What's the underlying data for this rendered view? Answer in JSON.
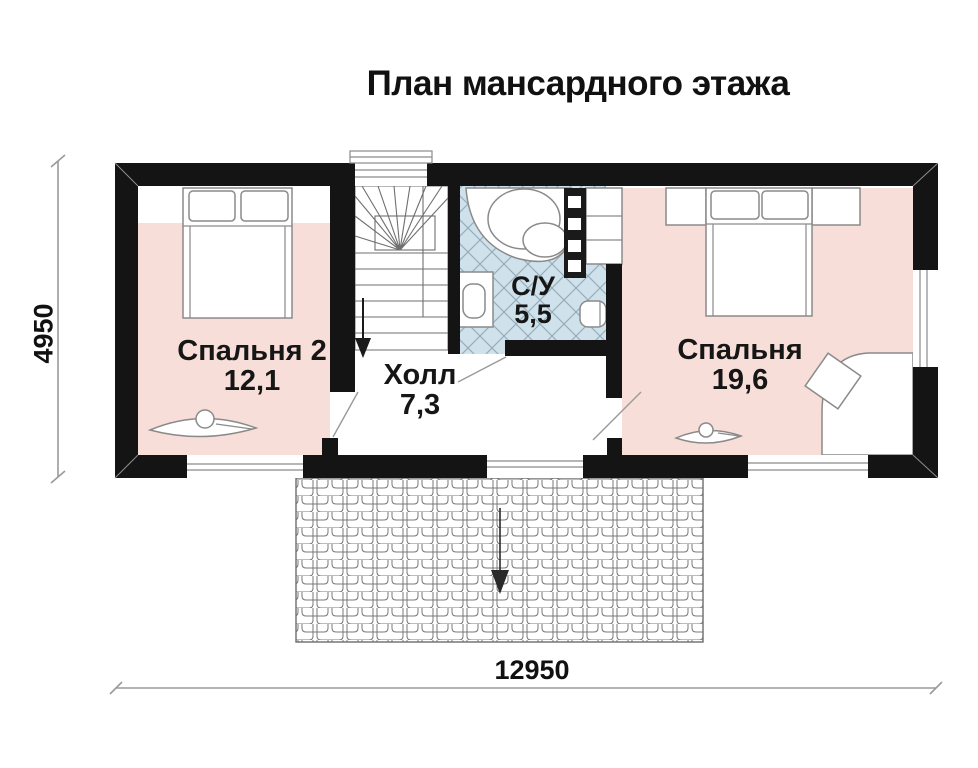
{
  "title": "План мансардного этажа",
  "rooms": {
    "bedroom2": {
      "name": "Спальня 2",
      "area": "12,1"
    },
    "hall": {
      "name": "Холл",
      "area": "7,3"
    },
    "bathroom": {
      "name": "С/У",
      "area": "5,5"
    },
    "bedroom1": {
      "name": "Спальня",
      "area": "19,6"
    }
  },
  "dimensions": {
    "total_width_mm": "12950",
    "total_depth_mm": "4950"
  },
  "colors": {
    "wall": "#141414",
    "floorPink": "#f8ded9",
    "floorTile": "#cfe2eb",
    "lineGray": "#8a8a8a",
    "dimLine": "#9a9a9a",
    "ink": "#161616"
  }
}
